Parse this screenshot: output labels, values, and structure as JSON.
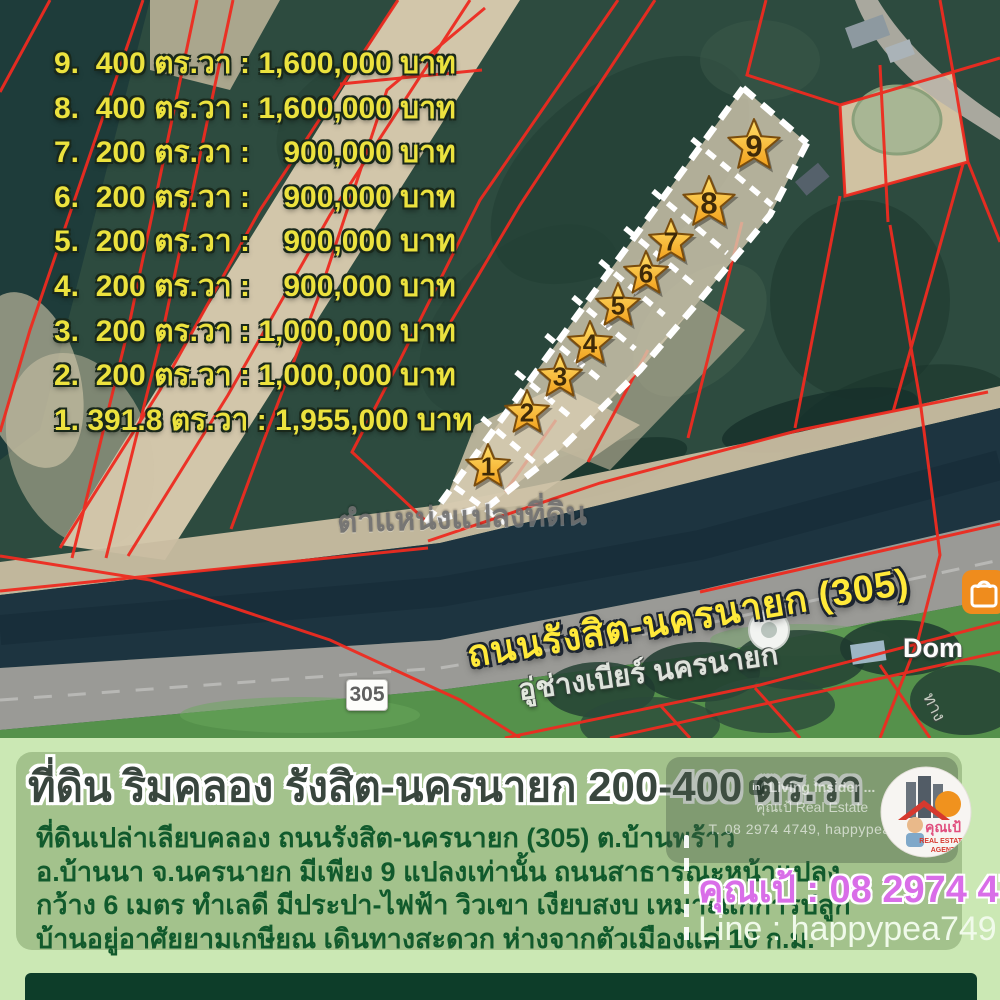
{
  "map": {
    "price_list": [
      {
        "no": "9",
        "area": "400 ตร.วา",
        "price": "1,600,000 บาท",
        "display": "9.  400 ตร.วา : 1,600,000 บาท"
      },
      {
        "no": "8",
        "area": "400 ตร.วา",
        "price": "1,600,000 บาท",
        "display": "8.  400 ตร.วา : 1,600,000 บาท"
      },
      {
        "no": "7",
        "area": "200 ตร.วา",
        "price": "900,000 บาท",
        "display": "7.  200 ตร.วา :    900,000 บาท"
      },
      {
        "no": "6",
        "area": "200 ตร.วา",
        "price": "900,000 บาท",
        "display": "6.  200 ตร.วา :    900,000 บาท"
      },
      {
        "no": "5",
        "area": "200 ตร.วา",
        "price": "900,000 บาท",
        "display": "5.  200 ตร.วา :    900,000 บาท"
      },
      {
        "no": "4",
        "area": "200 ตร.วา",
        "price": "900,000 บาท",
        "display": "4.  200 ตร.วา :    900,000 บาท"
      },
      {
        "no": "3",
        "area": "200 ตร.วา",
        "price": "1,000,000 บาท",
        "display": "3.  200 ตร.วา : 1,000,000 บาท"
      },
      {
        "no": "2",
        "area": "200 ตร.วา",
        "price": "1,000,000 บาท",
        "display": "2.  200 ตร.วา : 1,000,000 บาท"
      },
      {
        "no": "1",
        "area": "391.8 ตร.วา",
        "price": "1,955,000 บาท",
        "display": "1. 391.8 ตร.วา : 1,955,000 บาท"
      }
    ],
    "plot_markers": [
      {
        "n": "1",
        "x": 488,
        "y": 467,
        "r": 23
      },
      {
        "n": "2",
        "x": 527,
        "y": 413,
        "r": 23
      },
      {
        "n": "3",
        "x": 560,
        "y": 377,
        "r": 23
      },
      {
        "n": "4",
        "x": 590,
        "y": 344,
        "r": 23
      },
      {
        "n": "5",
        "x": 618,
        "y": 306,
        "r": 23
      },
      {
        "n": "6",
        "x": 646,
        "y": 274,
        "r": 23
      },
      {
        "n": "7",
        "x": 671,
        "y": 242,
        "r": 23
      },
      {
        "n": "8",
        "x": 709,
        "y": 203,
        "r": 27
      },
      {
        "n": "9",
        "x": 754,
        "y": 146,
        "r": 27
      }
    ],
    "road_label": "ถนนรังสิต-นครนายก (305)",
    "road_shield": "305",
    "road_sublabel": "อู่ช่างเบียร์ นครนายก",
    "position_watermark": "ตำแหน่งแปลงที่ดิน",
    "poi_label": "Dom",
    "side_label": "ทาง"
  },
  "panel": {
    "title": "ที่ดิน ริมคลอง รังสิต-นครนายก 200-400 ตร.วา",
    "description_lines": {
      "l1": "ที่ดินเปล่าเลียบคลอง ถนนรังสิต-นครนายก (305) ต.บ้านพร้าว",
      "l2": "อ.บ้านนา จ.นครนายก มีเพียง 9 แปลงเท่านั้น ถนนสาธารณะหน้าแปลง",
      "l3": "กว้าง 6 เมตร ทำเลดี มีประปา-ไฟฟ้า วิวเขา เงียบสงบ เหมาะแก่การปลูก",
      "l4": "บ้านอยู่อาศัยยามเกษียณ เดินทางสะดวก ห่างจากตัวเมืองแค่ 10 ก.ม."
    },
    "contact_phone": "คุณเป้ : 08 2974 4749",
    "contact_line": "Line : happypea749",
    "watermark": {
      "badge": "in",
      "line1": "Living Insider ...",
      "line2": "คุณเป้ Real Estate",
      "line3": "T. 08 2974 4749, happypea749"
    },
    "logo": {
      "name": "คุณเป้",
      "sub1": "REAL ESTATE",
      "sub2": "AGENT"
    }
  },
  "colors": {
    "parcel_red": "#ee2b20",
    "list_yellow": "#ece23e",
    "star_gold": "#ffc838",
    "panel_green": "#a3c28c",
    "background_green": "#cbe8b4",
    "dark_bar_green": "#0d3d29",
    "contact_pink": "#d96ee8",
    "description_green": "#115a2c"
  }
}
